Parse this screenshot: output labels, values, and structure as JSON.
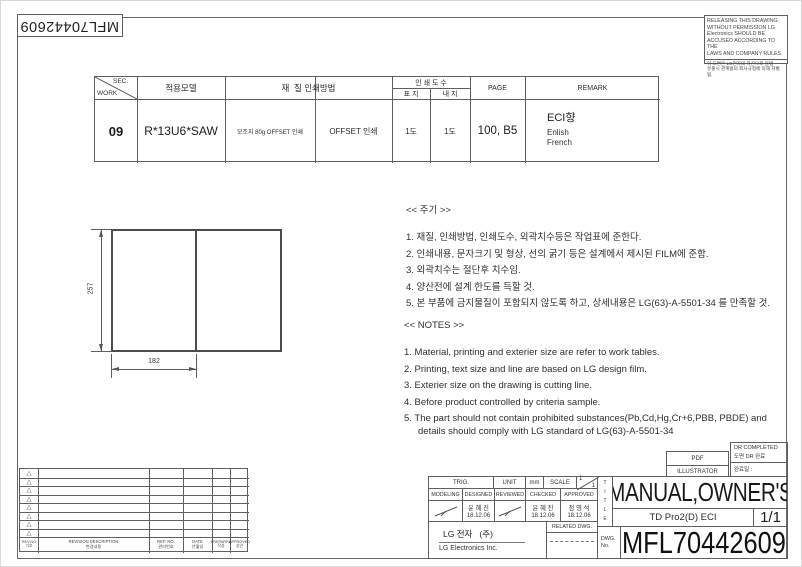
{
  "sheet": {
    "doc_number_top": "MFL70442609",
    "warning": {
      "en_lines": [
        "RELEASING THIS DRAWING",
        "WITHOUT PERMISSION LG",
        "Electronics SHOULD BE",
        "ACCUSED ACCORDING TO THE",
        "LAWS AND COMPANY RULES."
      ],
      "ko_lines": [
        "이 도면은 LG전자의 자산으로 불법",
        "유출시 관계법의 회사규정에 의해 처벌됨."
      ]
    }
  },
  "work_table": {
    "sec_label": "SEC.",
    "work_label": "WORK",
    "col_model": "적용모델",
    "col_material_method": "재  질 인쇄방법",
    "col_print_count": "인 쇄 도 수",
    "sub_cover": "표 지",
    "sub_inner": "내 지",
    "col_page": "PAGE",
    "col_remark": "REMARK",
    "row": {
      "sec": "09",
      "model": "R*13U6*SAW",
      "material": "모조지 80g OFFSET 인쇄",
      "method": "OFFSET 인쇄",
      "cover": "1도",
      "inner": "1도",
      "page": "100, B5",
      "remark1": "ECI향",
      "remark2": "Enlish",
      "remark3": "French"
    }
  },
  "drawing": {
    "dim_height": "257",
    "dim_width": "182"
  },
  "notes_ko": {
    "title": "<< 주기 >>",
    "items": [
      "1. 재질, 인쇄방법, 인쇄도수, 외곽치수등은 작업표에 준한다.",
      "2. 인쇄내용, 문자크기 및 형상, 선의 굵기 등은 설계에서 제시된 FILM에 준함.",
      "3. 외곽치수는 절단후 치수임.",
      "4. 양산전에 설계 한도를 득할 것.",
      "5. 본 부품에 금지물질이 포함되지 않도록 하고, 상세내용은 LG(63)-A-5501-34 를 만족할 것."
    ]
  },
  "notes_en": {
    "title": "<< NOTES >>",
    "items": [
      "1. Material, printing and exterier size are refer to work tables.",
      "2. Printing, text size and line are based on LG design film.",
      "3. Exterier size on the drawing is cutting line.",
      "4. Before product controlled by criteria sample.",
      "5. The part should not contain prohibited substances(Pb,Cd,Hg,Cr+6,PBB, PBDE) and details should comply with LG standard of LG(63)-A-5501-34"
    ]
  },
  "revision": {
    "symbol": "△",
    "rows": [
      "△",
      "△",
      "△",
      "△",
      "△",
      "△",
      "△",
      "△"
    ],
    "headers": {
      "rev_en": "REV.NO",
      "rev_ko": "기호",
      "desc_en": "REVISION DESCRIPTION",
      "desc_ko": "변경내용",
      "ref_en": "REF. NO.",
      "ref_ko": "관리번호",
      "date_en": "DATE",
      "date_ko": "년월일",
      "prep_en": "PREPARED",
      "prep_ko": "작성",
      "appr_en": "APPROVED",
      "appr_ko": "승인"
    }
  },
  "title_block": {
    "trig": "TRIG.",
    "unit": "UNIT",
    "unit_value": "mm",
    "scale": "SCALE",
    "scale_top": "1",
    "scale_bottom": "1",
    "modeling": "MODELING",
    "designed": "DESIGNED",
    "reviewed": "REVIEWED",
    "checked": "CHECKED",
    "approved": "APPROVED",
    "designed_name": "윤 혜 진",
    "designed_date": "18.12.06",
    "checked_name": "윤 혜 진",
    "checked_date": "18.12.06",
    "approved_name": "정 영 석",
    "approved_date": "18.12.06",
    "company_ko": "LG 전자   (주)",
    "company_en": "LG Electronics Inc.",
    "related": "RELATED DWG.",
    "pdf": "PDF",
    "illustrator": "ILLUSTRATOR",
    "dr_completed_en": "DR COMPLETED",
    "dr_completed_ko": "도면 DR 완료",
    "dr_date_label": "완료일 :",
    "title_vertical": "TITLE",
    "title": "MANUAL,OWNER'S",
    "subtitle": "TD Pro2(D) ECI",
    "sheet_no": "1/1",
    "dwg_label": "DWG.",
    "dwg_label2": "No.",
    "dwg_no": "MFL70442609"
  }
}
